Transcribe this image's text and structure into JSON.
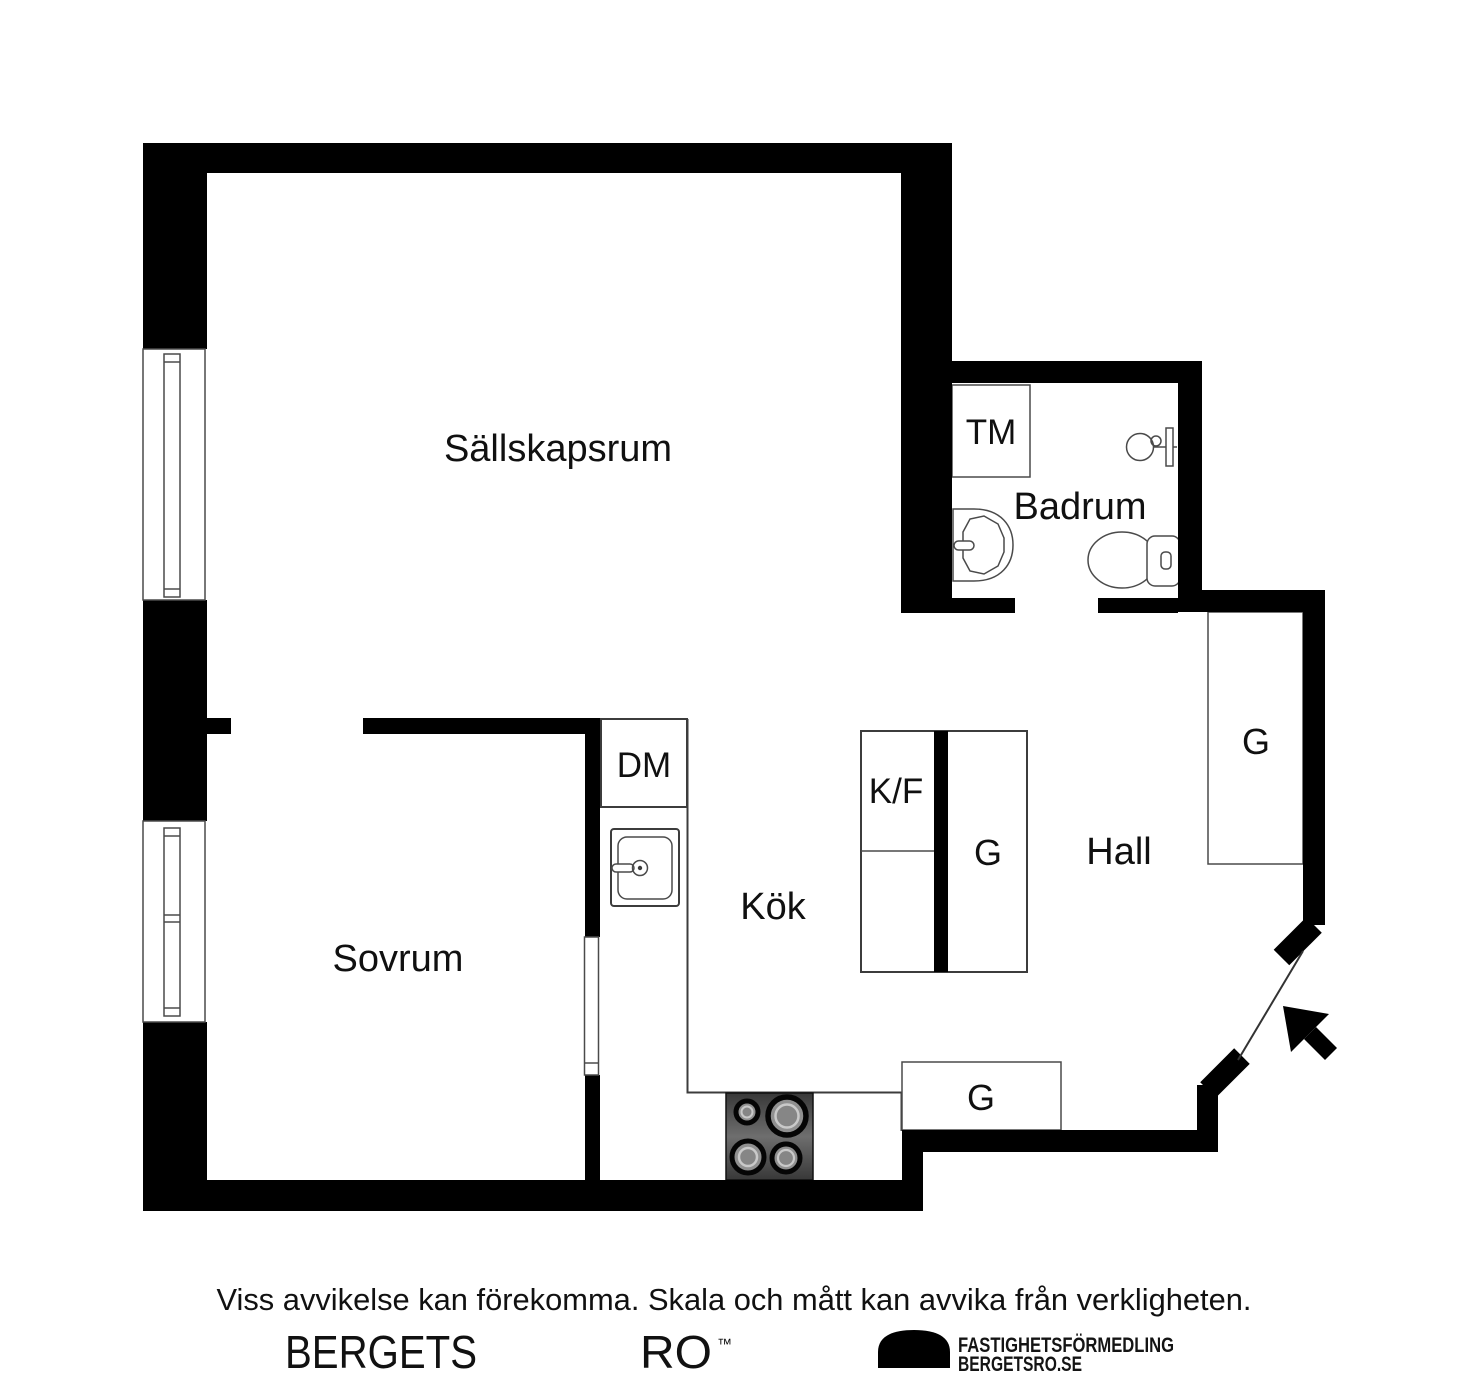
{
  "page": {
    "background": "#ffffff"
  },
  "floorplan": {
    "rooms": [
      {
        "id": "sallskapsrum",
        "label": "Sällskapsrum"
      },
      {
        "id": "sovrum",
        "label": "Sovrum"
      },
      {
        "id": "kok",
        "label": "Kök"
      },
      {
        "id": "badrum",
        "label": "Badrum"
      },
      {
        "id": "hall",
        "label": "Hall"
      }
    ],
    "units": [
      {
        "id": "tm",
        "label": "TM"
      },
      {
        "id": "dm",
        "label": "DM"
      },
      {
        "id": "kf",
        "label": "K/F"
      },
      {
        "id": "g-kitchen",
        "label": "G"
      },
      {
        "id": "g-hall",
        "label": "G"
      },
      {
        "id": "g-entry",
        "label": "G"
      }
    ],
    "colors": {
      "wall": "#000000",
      "line": "#3c3c3c",
      "label": "#101010",
      "stove": "#4a4a4a",
      "burner": "#8f8f8f"
    },
    "icons": [
      "window-icon",
      "sliding-door-icon",
      "entry-door-icon",
      "entrance-arrow-icon",
      "toilet-icon",
      "bathroom-sink-icon",
      "shower-mixer-icon",
      "kitchen-sink-icon",
      "stove-icon",
      "brand-dome-icon"
    ]
  },
  "footer": {
    "disclaimer": "Viss avvikelse kan förekomma. Skala och mått kan avvika från verkligheten.",
    "brand_word_1": "BERGETS",
    "brand_word_2": "RO",
    "trademark": "™",
    "agency_line_1": "FASTIGHETSFÖRMEDLING",
    "agency_line_2": "BERGETSRO.SE"
  }
}
